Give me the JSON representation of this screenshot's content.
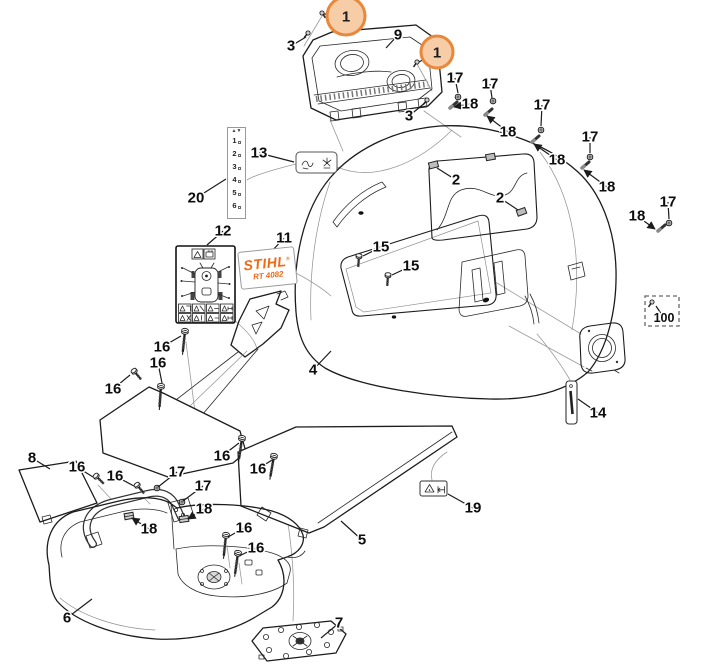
{
  "page": {
    "background": "#ffffff"
  },
  "palette": {
    "line": "#1c1c1c",
    "guide": "#9a9a9a",
    "accent_orange": "#ef6a17",
    "badge_fill": "#f6cda6",
    "badge_stroke": "#e9873a"
  },
  "stihl_label": {
    "brand": "STIHL",
    "reg_mark": "®",
    "model": "RT 4082"
  },
  "height_strip": {
    "top_icon": "▲▼",
    "ticks": [
      "1",
      "2",
      "3",
      "4",
      "5",
      "6"
    ]
  },
  "small_labels": {
    "label_13": "throttle-choke-pictogram-label",
    "label_19": "warning-deflector-pictogram-label",
    "label_12": "operator-warning-pictogram-label"
  },
  "badges": [
    {
      "label": "1",
      "x": 346,
      "y": 16,
      "r": 19,
      "tx": 324,
      "ty": 14
    },
    {
      "label": "1",
      "x": 437,
      "y": 52,
      "r": 16,
      "tx": 419,
      "ty": 62
    }
  ],
  "callouts": [
    {
      "n": "3",
      "x": 291,
      "y": 46,
      "tx": 306,
      "ty": 37
    },
    {
      "n": "9",
      "x": 398,
      "y": 35,
      "tx": 386,
      "ty": 48
    },
    {
      "n": "3",
      "x": 409,
      "y": 116,
      "tx": 426,
      "ty": 102
    },
    {
      "n": "17",
      "x": 455,
      "y": 78,
      "tx": 458,
      "ty": 93
    },
    {
      "n": "18",
      "x": 470,
      "y": 104,
      "tx": 454,
      "ty": 107,
      "arrow": true
    },
    {
      "n": "17",
      "x": 490,
      "y": 84,
      "tx": 492,
      "ty": 98
    },
    {
      "n": "18",
      "x": 508,
      "y": 132,
      "tx": 487,
      "ty": 116,
      "arrow": true
    },
    {
      "n": "17",
      "x": 542,
      "y": 105,
      "tx": 541,
      "ty": 126
    },
    {
      "n": "18",
      "x": 557,
      "y": 160,
      "tx": 534,
      "ty": 144,
      "arrow": true
    },
    {
      "n": "17",
      "x": 590,
      "y": 137,
      "tx": 590,
      "ty": 153
    },
    {
      "n": "18",
      "x": 607,
      "y": 187,
      "tx": 584,
      "ty": 170,
      "arrow": true
    },
    {
      "n": "17",
      "x": 668,
      "y": 202,
      "tx": 669,
      "ty": 219
    },
    {
      "n": "18",
      "x": 637,
      "y": 216,
      "tx": 655,
      "ty": 229,
      "arrow": true
    },
    {
      "n": "2",
      "x": 456,
      "y": 180,
      "tx": 437,
      "ty": 168
    },
    {
      "n": "2",
      "x": 500,
      "y": 198,
      "tx": 518,
      "ty": 210
    },
    {
      "n": "13",
      "x": 259,
      "y": 153,
      "tx": 294,
      "ty": 162
    },
    {
      "n": "20",
      "x": 196,
      "y": 198,
      "tx": 226,
      "ty": 179
    },
    {
      "n": "12",
      "x": 223,
      "y": 231,
      "tx": 207,
      "ty": 245
    },
    {
      "n": "11",
      "x": 284,
      "y": 238,
      "tx": 272,
      "ty": 251
    },
    {
      "n": "15",
      "x": 381,
      "y": 247,
      "tx": 363,
      "ty": 256
    },
    {
      "n": "15",
      "x": 411,
      "y": 266,
      "tx": 392,
      "ty": 275
    },
    {
      "n": "4",
      "x": 313,
      "y": 370,
      "tx": 331,
      "ty": 351
    },
    {
      "n": "100",
      "x": 664,
      "y": 318,
      "tx": 656,
      "ty": 306,
      "small": true
    },
    {
      "n": "14",
      "x": 598,
      "y": 413,
      "tx": 578,
      "ty": 399
    },
    {
      "n": "16",
      "x": 162,
      "y": 347,
      "tx": 181,
      "ty": 336
    },
    {
      "n": "16",
      "x": 158,
      "y": 363,
      "tx": 162,
      "ty": 383
    },
    {
      "n": "16",
      "x": 113,
      "y": 389,
      "tx": 130,
      "ty": 375
    },
    {
      "n": "16",
      "x": 222,
      "y": 456,
      "tx": 239,
      "ty": 443
    },
    {
      "n": "16",
      "x": 258,
      "y": 469,
      "tx": 272,
      "ty": 460
    },
    {
      "n": "16",
      "x": 77,
      "y": 467,
      "tx": 93,
      "ty": 477
    },
    {
      "n": "16",
      "x": 115,
      "y": 476,
      "tx": 134,
      "ty": 486
    },
    {
      "n": "17",
      "x": 177,
      "y": 472,
      "tx": 158,
      "ty": 487
    },
    {
      "n": "17",
      "x": 203,
      "y": 486,
      "tx": 183,
      "ty": 501
    },
    {
      "n": "18",
      "x": 149,
      "y": 529,
      "tx": 132,
      "ty": 518,
      "arrow": true
    },
    {
      "n": "18",
      "x": 204,
      "y": 509,
      "tx": 188,
      "ty": 519,
      "arrow": true
    },
    {
      "n": "16",
      "x": 244,
      "y": 528,
      "tx": 228,
      "ty": 537
    },
    {
      "n": "16",
      "x": 256,
      "y": 548,
      "tx": 239,
      "ty": 556
    },
    {
      "n": "8",
      "x": 32,
      "y": 458,
      "tx": 50,
      "ty": 469
    },
    {
      "n": "6",
      "x": 67,
      "y": 618,
      "tx": 92,
      "ty": 599
    },
    {
      "n": "5",
      "x": 362,
      "y": 540,
      "tx": 341,
      "ty": 521
    },
    {
      "n": "7",
      "x": 339,
      "y": 623,
      "tx": 321,
      "ty": 638
    },
    {
      "n": "19",
      "x": 473,
      "y": 508,
      "tx": 448,
      "ty": 494
    }
  ]
}
